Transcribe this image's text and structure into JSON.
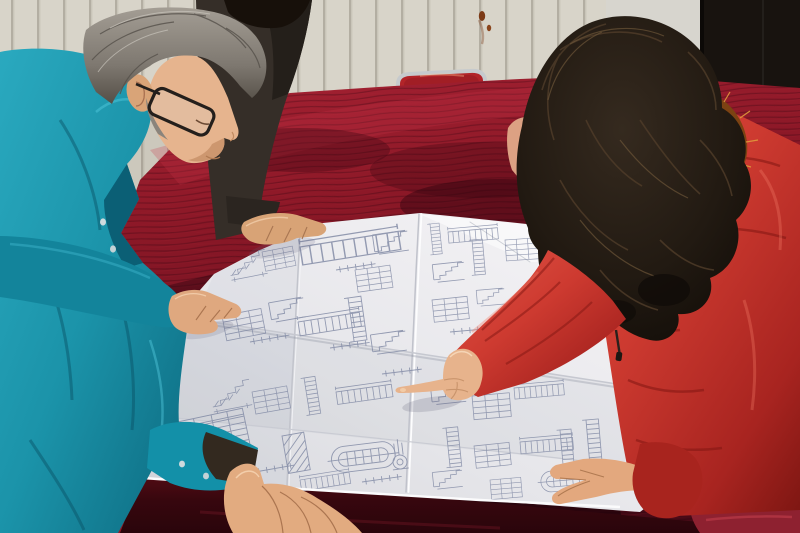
{
  "title": "Two workers reviewing an unfolded construction blueprint on a red velvet table",
  "scene": {
    "background": {
      "wall": {
        "label": "cream slatted wall paneling",
        "color": "#d8d4c9",
        "slat_color": "#b2ada1"
      },
      "panel": {
        "label": "smooth wall panel with rust stains",
        "color": "#d7d5ce",
        "stain_color": "#7c3a16"
      },
      "doorway": {
        "label": "dark open doorway",
        "color": "#18130f"
      },
      "chair": {
        "label": "chrome framed chair with red back",
        "frame_color": "#c6cacd",
        "back_color": "#b22429"
      }
    },
    "table": {
      "label": "table draped in red velvet",
      "velvet_bright": "#a32132",
      "velvet_mid": "#8a1827",
      "velvet_dark": "#3c0811"
    },
    "blueprint": {
      "label": "large unfolded engineering drawing sheet with fold creases",
      "paper_color": "#e9e9ec",
      "line_color": "#7d86a2",
      "content": "stair sections, structural details, dimension strings and schedule tables"
    },
    "people": {
      "man": {
        "label": "gray-haired man in teal work jacket with dark glasses leaning over the drawing",
        "jacket_color": "#1b93a9",
        "hair_color": "#7e7870",
        "pose": "both hands resting on the sheet"
      },
      "colleague": {
        "label": "partially visible colleague in dark jacket",
        "jacket_color": "#352e28",
        "pose": "one hand resting on the sheet"
      },
      "woman": {
        "label": "woman in red down coat with fur-trimmed hood and long dark hair",
        "coat_color": "#c93a31",
        "hair_color": "#1c1510",
        "fur_color": "#b96b24",
        "pose": "pointing at the drawing with right index finger"
      }
    }
  }
}
